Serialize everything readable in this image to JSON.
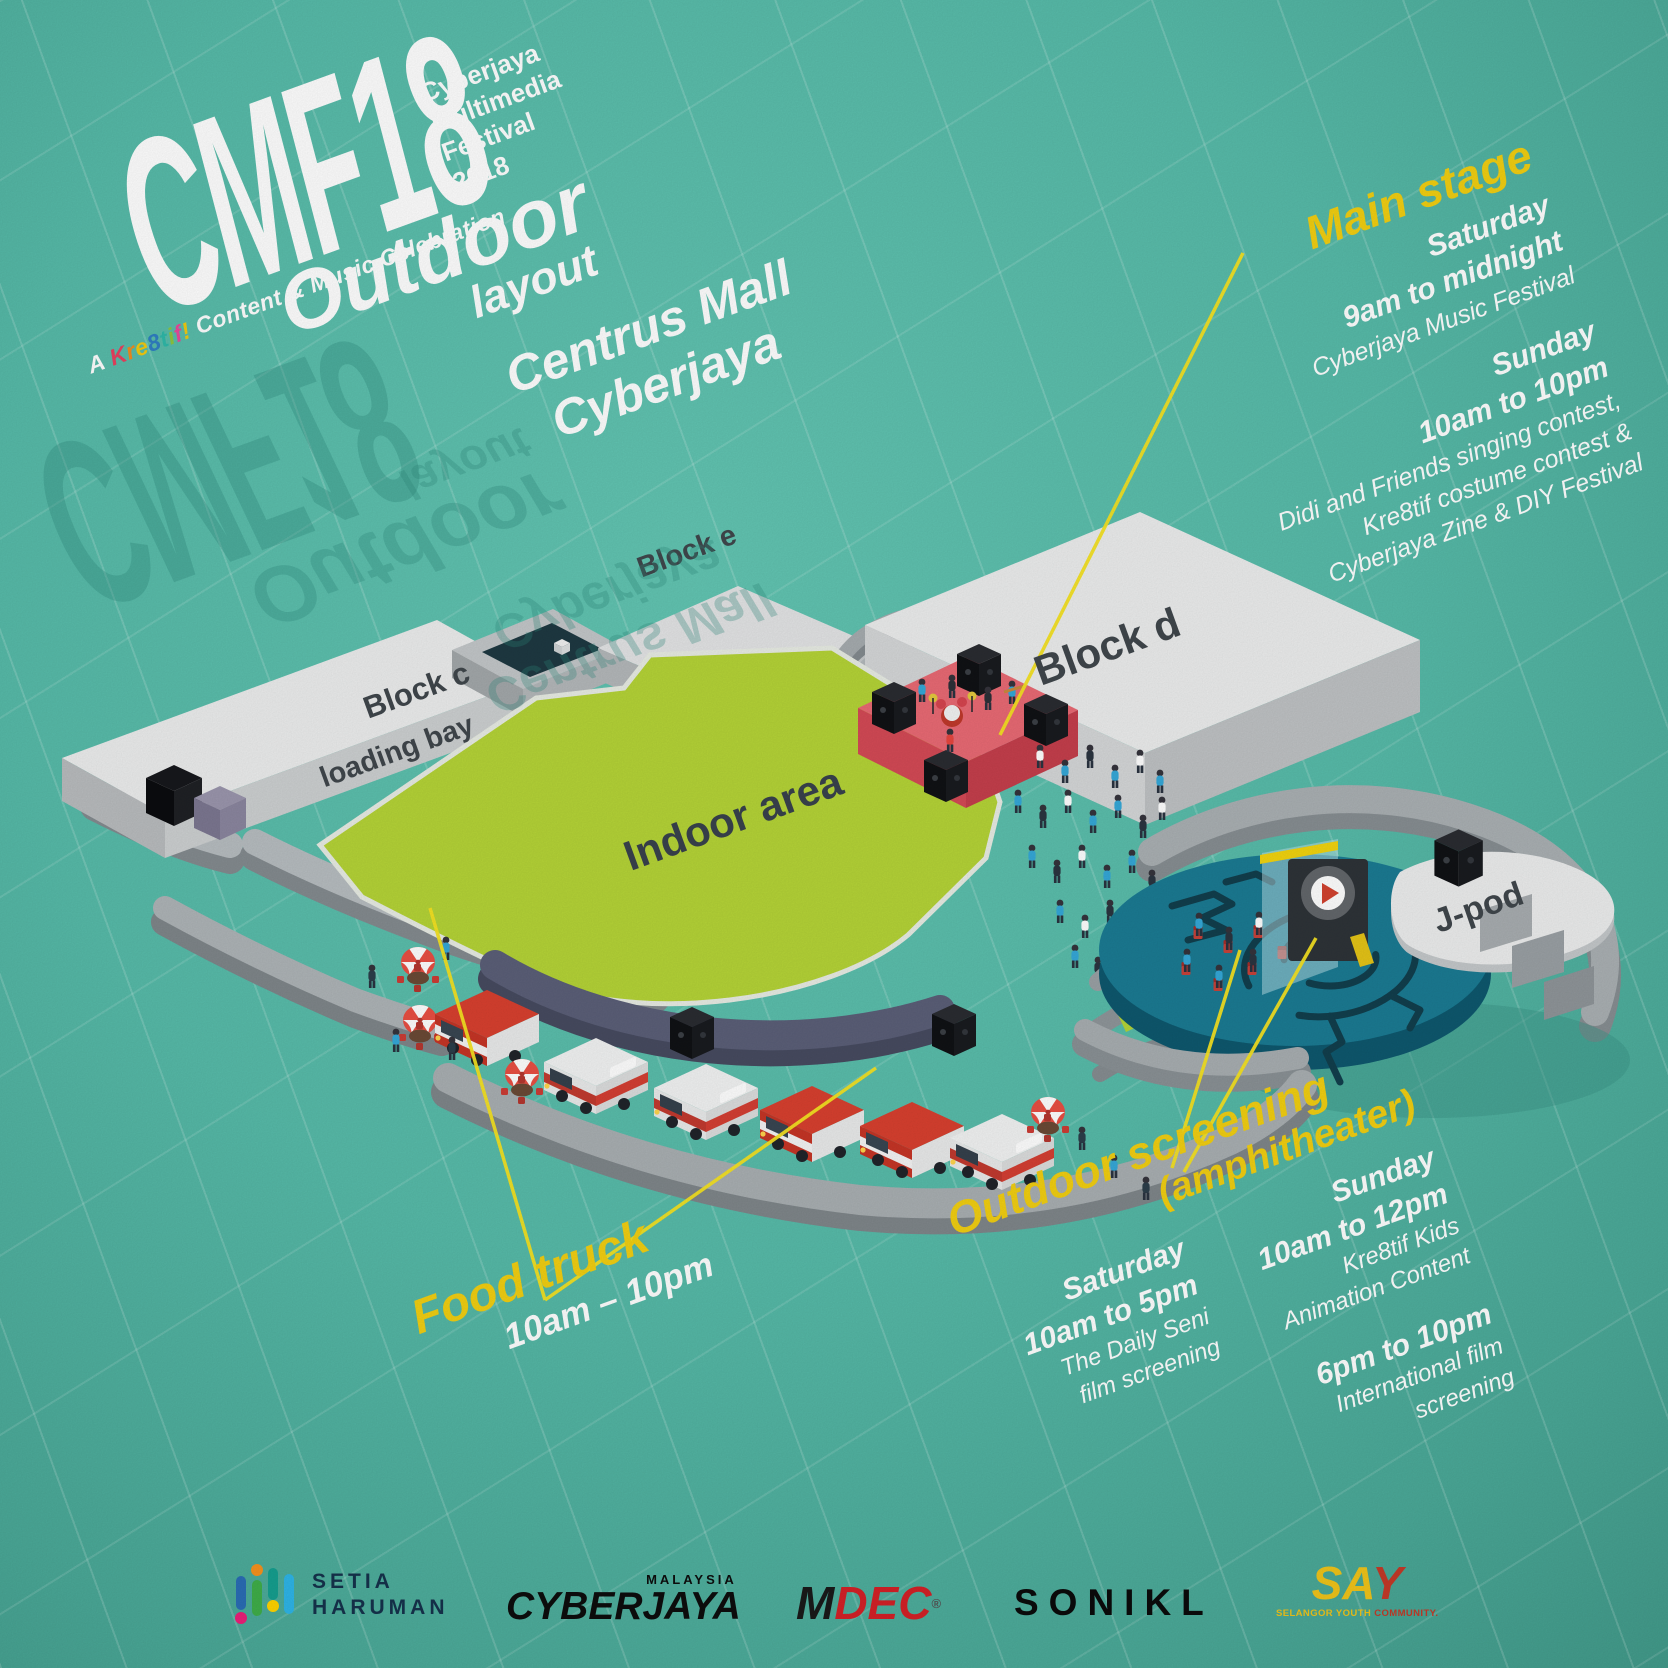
{
  "branding": {
    "logo": "CMF18",
    "logo_sub_line1": "Cyberjaya",
    "logo_sub_line2": "Multimedia",
    "logo_sub_line3": "Festival",
    "logo_sub_line4": "2018",
    "tagline_prefix": "A",
    "kre8tif_letters": [
      "K",
      "r",
      "e",
      "8",
      "t",
      "i",
      "f",
      "!"
    ],
    "tagline_suffix": "Content & Music Celebration"
  },
  "title": {
    "heading": "Outdoor",
    "subheading": "layout",
    "venue_line1": "Centrus Mall",
    "venue_line2": "Cyberjaya"
  },
  "main_stage": {
    "heading": "Main stage",
    "saturday_label": "Saturday",
    "saturday_time": "9am to midnight",
    "saturday_event": "Cyberjaya Music Festival",
    "sunday_label": "Sunday",
    "sunday_time": "10am to 10pm",
    "sunday_event_line1": "Didi and Friends singing contest,",
    "sunday_event_line2": "Kre8tif costume contest &",
    "sunday_event_line3": "Cyberjaya Zine & DIY Festival"
  },
  "food_truck": {
    "heading": "Food truck",
    "time": "10am – 10pm"
  },
  "outdoor_screening": {
    "heading": "Outdoor screening",
    "subheading": "(amphitheater)",
    "saturday_label": "Saturday",
    "saturday_time": "10am to 5pm",
    "saturday_event_line1": "The Daily Seni",
    "saturday_event_line2": "film screening",
    "sunday_label": "Sunday",
    "sunday_time": "10am to 12pm",
    "sunday_event_line1": "Kre8tif Kids",
    "sunday_event_line2": "Animation Content",
    "sunday_evening_time": "6pm to 10pm",
    "sunday_evening_line1": "International film",
    "sunday_evening_line2": "screening"
  },
  "map_labels": {
    "block_c": "Block c",
    "loading_bay": "loading bay",
    "block_e": "Block e",
    "block_d": "Block d",
    "indoor_area": "Indoor area",
    "j_pod": "J-pod"
  },
  "sponsors": {
    "setia_line1": "SETIA",
    "setia_line2": "HARUMAN",
    "cyberjaya_country": "MALAYSIA",
    "cyberjaya": "CYBERJAYA",
    "mdec_m": "M",
    "mdec_dec": "DEC",
    "mdec_reg": "®",
    "sonikl": "SONIKL",
    "say": {
      "sa": "SA",
      "y": "Y"
    },
    "say_sub_yellow": "SELANGOR YOUTH",
    "say_sub_red": "COMMUNITY."
  },
  "colors": {
    "background_teal": "#57BBA9",
    "indoor_green": "#B5D437",
    "accent_yellow": "#F2CF12",
    "stage_red": "#E96A74",
    "amphitheater_teal": "#1B7B93",
    "truck_red": "#D8402F",
    "crowd_blue": "#35A8D8",
    "building_gray": "#ECEDED"
  }
}
